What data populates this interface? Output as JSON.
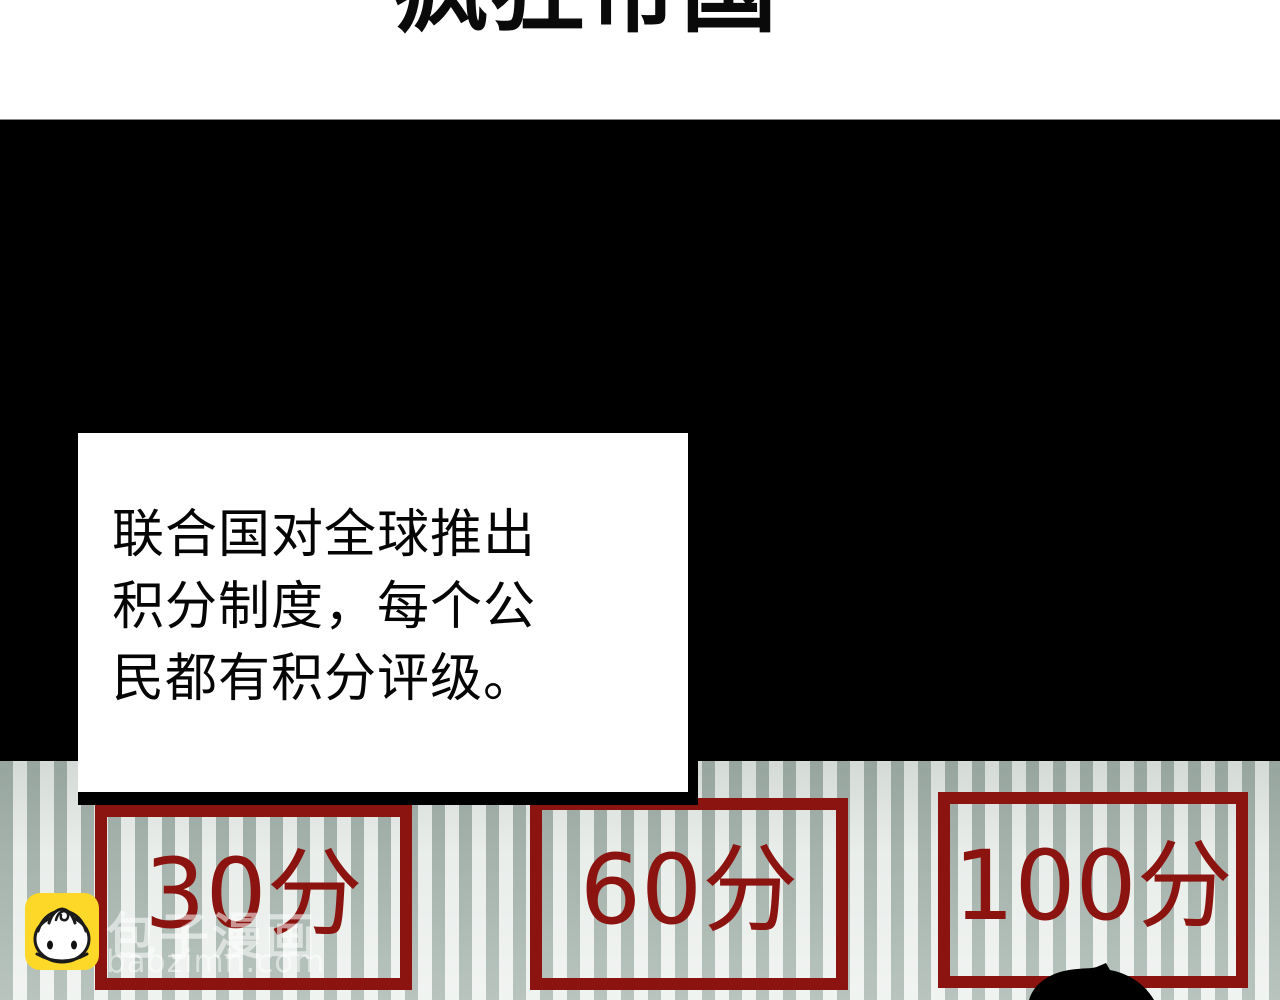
{
  "chapter": {
    "title": "疯狂帝国"
  },
  "narration": {
    "lines": [
      "联合国对全球推出",
      "积分制度，每个公",
      "民都有积分评级。"
    ]
  },
  "scores": {
    "items": [
      {
        "label": "30分"
      },
      {
        "label": "60分"
      },
      {
        "label": "100分"
      }
    ]
  },
  "watermark": {
    "site_name": "包子漫画",
    "site_domain": "baozimh.com",
    "mascot_icon": "baozi-bun-icon"
  },
  "colors": {
    "accent_red": "#8b1410",
    "panel_black": "#000000",
    "stripe_sage": "#a7b5ae",
    "stripe_white": "#edf1ee",
    "mascot_yellow": "#fed828"
  }
}
